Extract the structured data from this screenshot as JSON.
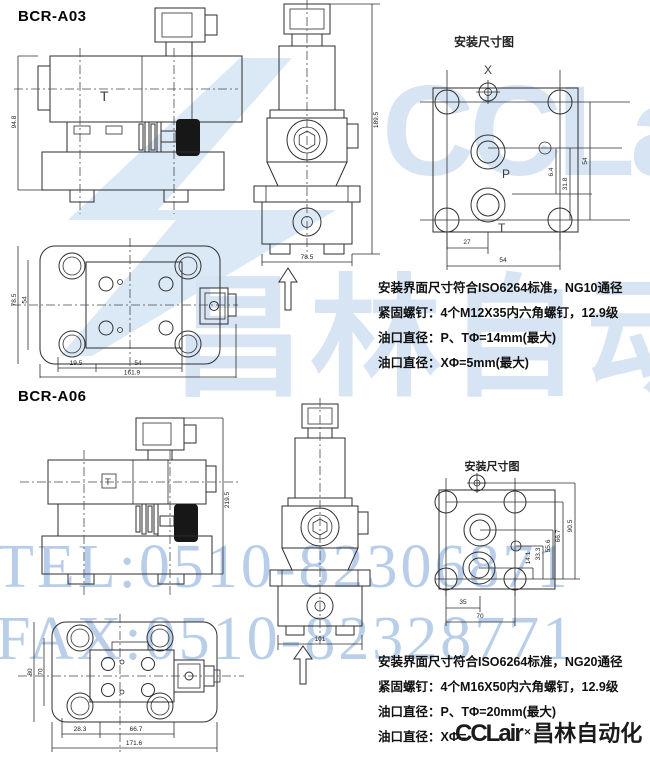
{
  "watermarks": {
    "tel": "TEL:0510-82306871",
    "fax": "FAX:0510-82328771",
    "brand_latin": "CCLair",
    "brand_cn": "昌林自动化"
  },
  "footer_logo": {
    "brand_latin": "CCLair",
    "mark": "✕",
    "brand_cn": "昌林自动化"
  },
  "a03": {
    "title": "BCR-A03",
    "side_view": {
      "label_t": "T",
      "dim_height": "94.8"
    },
    "front_view": {
      "dim_width": "78.5",
      "dim_height": "189.5"
    },
    "top_view": {
      "dim_h_outer": "78.5",
      "dim_h_inner": "54",
      "dim_a": "19.5",
      "dim_b": "54",
      "dim_total": "161.9"
    },
    "mount": {
      "title": "安装尺寸图",
      "port_x": "X",
      "port_p": "P",
      "port_t": "T",
      "dim_v1": "6.4",
      "dim_v2": "31.8",
      "dim_v3": "54",
      "dim_h1": "27",
      "dim_h2": "54"
    },
    "notes": [
      "安装界面尺寸符合ISO6264标准，NG10通径",
      "紧固螺钉：4个M12X35内六角螺钉，12.9级",
      "油口直径：P、TΦ=14mm(最大)",
      "油口直径：XΦ=5mm(最大)"
    ]
  },
  "a06": {
    "title": "BCR-A06",
    "side_view": {
      "label_t": "T",
      "dim_height": "219.5"
    },
    "front_view": {
      "dim_width": "101"
    },
    "top_view": {
      "dim_h_outer": "80",
      "dim_h_inner": "70",
      "dim_a": "28.3",
      "dim_b": "66.7",
      "dim_total": "171.6"
    },
    "mount": {
      "title": "安装尺寸图",
      "dim_v1": "14.1",
      "dim_v2": "33.3",
      "dim_v3": "55.6",
      "dim_v4": "66.7",
      "dim_v5": "90.5",
      "dim_h1": "35",
      "dim_h2": "70"
    },
    "notes": [
      "安装界面尺寸符合ISO6264标准，NG20通径",
      "紧固螺钉：4个M16X50内六角螺钉，12.9级",
      "油口直径：P、TΦ=20mm(最大)",
      "油口直径：XΦ="
    ]
  }
}
